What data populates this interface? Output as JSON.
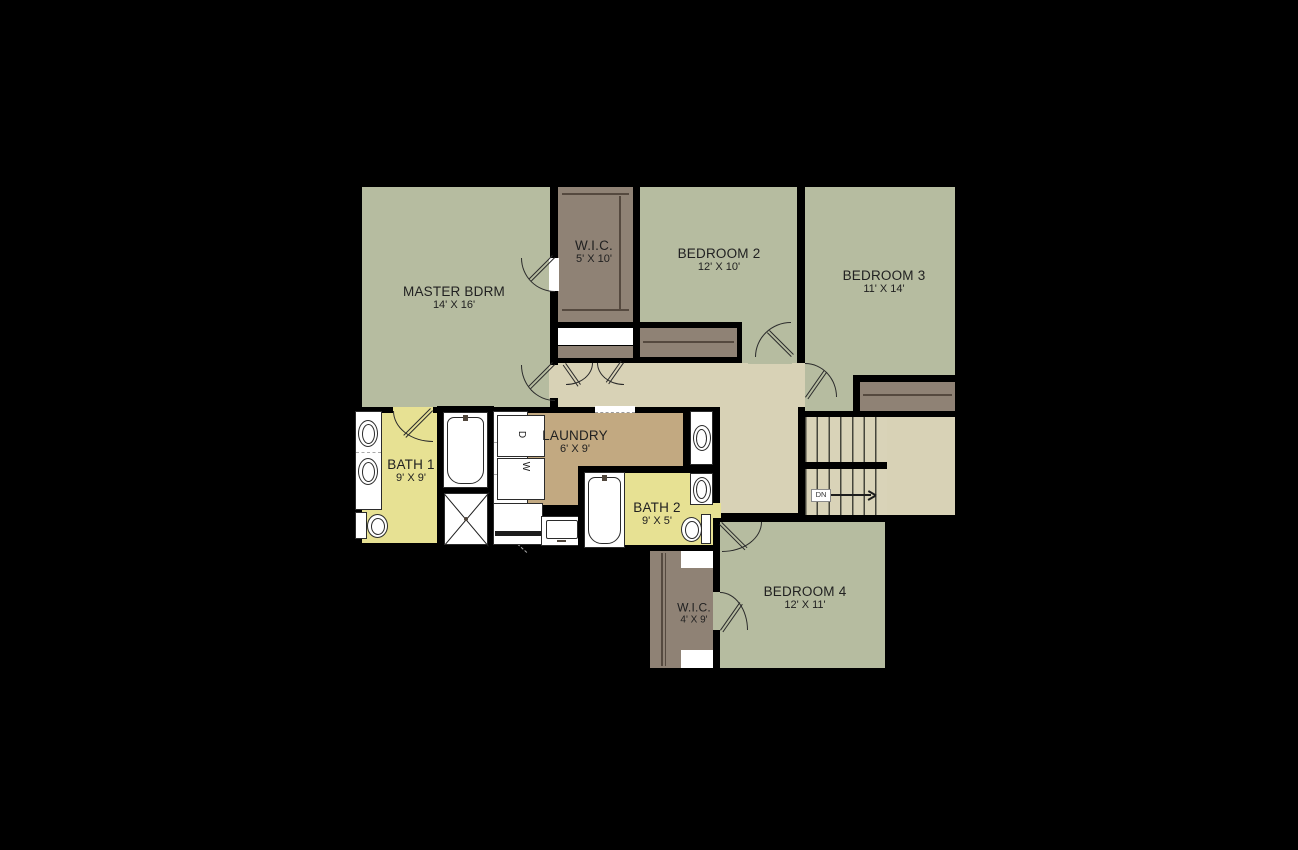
{
  "plan": {
    "type_label": "second floor plan",
    "rooms": {
      "master": {
        "name": "MASTER BDRM",
        "dims": "14' X 16'"
      },
      "wic_top": {
        "name": "W.I.C.",
        "dims": "5' X 10'"
      },
      "bedroom2": {
        "name": "BEDROOM 2",
        "dims": "12' X 10'"
      },
      "bedroom3": {
        "name": "BEDROOM 3",
        "dims": "11' X 14'"
      },
      "bath1": {
        "name": "BATH 1",
        "dims": "9' X 9'"
      },
      "laundry": {
        "name": "LAUNDRY",
        "dims": "6' X 9'"
      },
      "bath2": {
        "name": "BATH 2",
        "dims": "9' X 5'"
      },
      "bedroom4": {
        "name": "BEDROOM 4",
        "dims": "12' X 11'"
      },
      "wic4": {
        "name": "W.I.C.",
        "dims": "4' X 9'"
      }
    },
    "stairs": {
      "dn_label": "DN"
    },
    "appliances": {
      "dryer_label": "D",
      "washer_label": "W"
    },
    "colors": {
      "wall_black": "#000000",
      "room_green": "#b6bca0",
      "hall_tan": "#d8d2b6",
      "closet_brown": "#8f8275",
      "laundry_tan": "#c2a981",
      "bath_yellow": "#e7e193",
      "fixture_white": "#ffffff"
    }
  }
}
